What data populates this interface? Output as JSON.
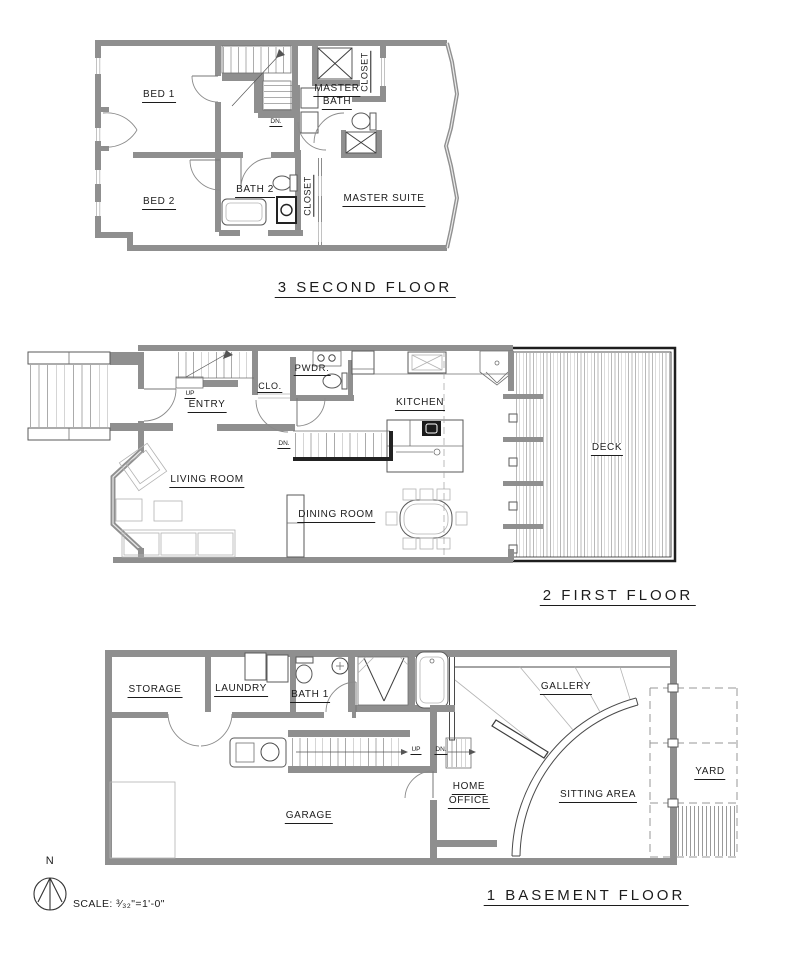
{
  "floors": {
    "second": {
      "title": "3 SECOND FLOOR",
      "bed1": "BED 1",
      "bed2": "BED 2",
      "bath2": "BATH 2",
      "closet_a": "CLOSET",
      "closet_b": "CLOSET",
      "master_bath_l1": "MASTER",
      "master_bath_l2": "BATH",
      "master_suite": "MASTER SUITE",
      "stair_dn": "DN."
    },
    "first": {
      "title": "2 FIRST FLOOR",
      "entry": "ENTRY",
      "closet": "CLO.",
      "powder": "PWDR.",
      "kitchen": "KITCHEN",
      "living": "LIVING ROOM",
      "dining": "DINING ROOM",
      "deck": "DECK",
      "stair_up": "UP",
      "stair_dn": "DN."
    },
    "basement": {
      "title": "1 BASEMENT FLOOR",
      "storage": "STORAGE",
      "laundry": "LAUNDRY",
      "bath1": "BATH 1",
      "garage": "GARAGE",
      "home_office_l1": "HOME",
      "home_office_l2": "OFFICE",
      "gallery": "GALLERY",
      "sitting": "SITTING AREA",
      "yard": "YARD",
      "stair_up": "UP",
      "stair_dn": "DN.",
      "stair_dn2": "DN."
    }
  },
  "compass": {
    "north": "N"
  },
  "scale": {
    "label": "SCALE:",
    "value": "³⁄₃₂\"=1'-0\""
  },
  "colors": {
    "wall": "#8f8f8f",
    "line": "#4a4a4a",
    "light_line": "#b3b3b3",
    "dark": "#1e1e1e",
    "text": "#1c1c1c",
    "background": "#ffffff"
  }
}
